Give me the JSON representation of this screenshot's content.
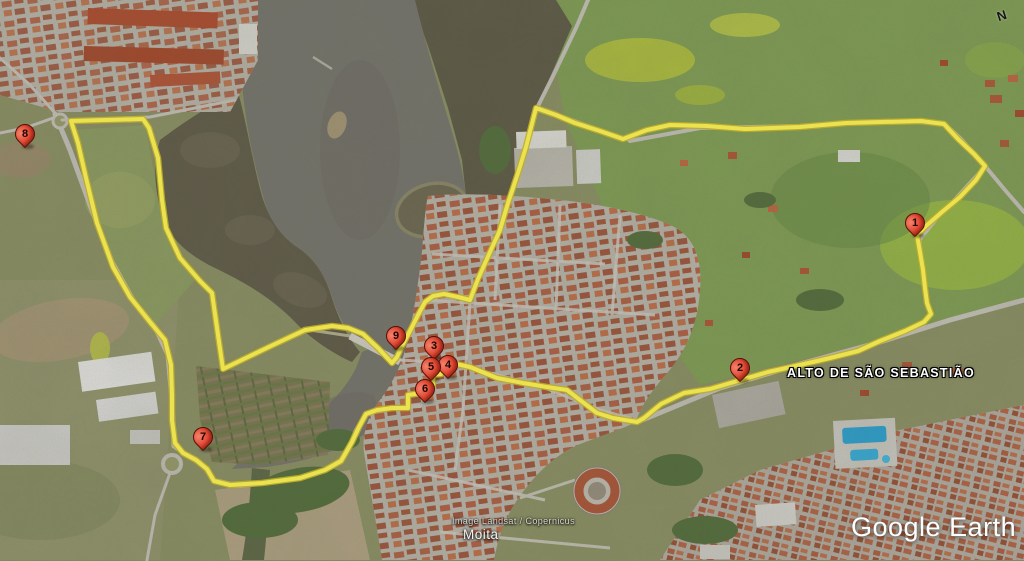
{
  "map": {
    "place_label": "ALTO DE SÃO SEBASTIÃO",
    "attribution": "Image Landsat / Copernicus",
    "city_label": "Moita",
    "logo": "Google Earth",
    "compass_label": "N",
    "route_color": "#f8f055",
    "marker_color": "#e0402b",
    "water_color": "#787771",
    "markers": [
      {
        "label": "1",
        "x": 915,
        "y": 237
      },
      {
        "label": "2",
        "x": 740,
        "y": 382
      },
      {
        "label": "3",
        "x": 434,
        "y": 360
      },
      {
        "label": "4",
        "x": 448,
        "y": 379
      },
      {
        "label": "5",
        "x": 431,
        "y": 381
      },
      {
        "label": "6",
        "x": 425,
        "y": 403
      },
      {
        "label": "7",
        "x": 203,
        "y": 451
      },
      {
        "label": "8",
        "x": 25,
        "y": 148
      },
      {
        "label": "9",
        "x": 396,
        "y": 350
      }
    ]
  }
}
